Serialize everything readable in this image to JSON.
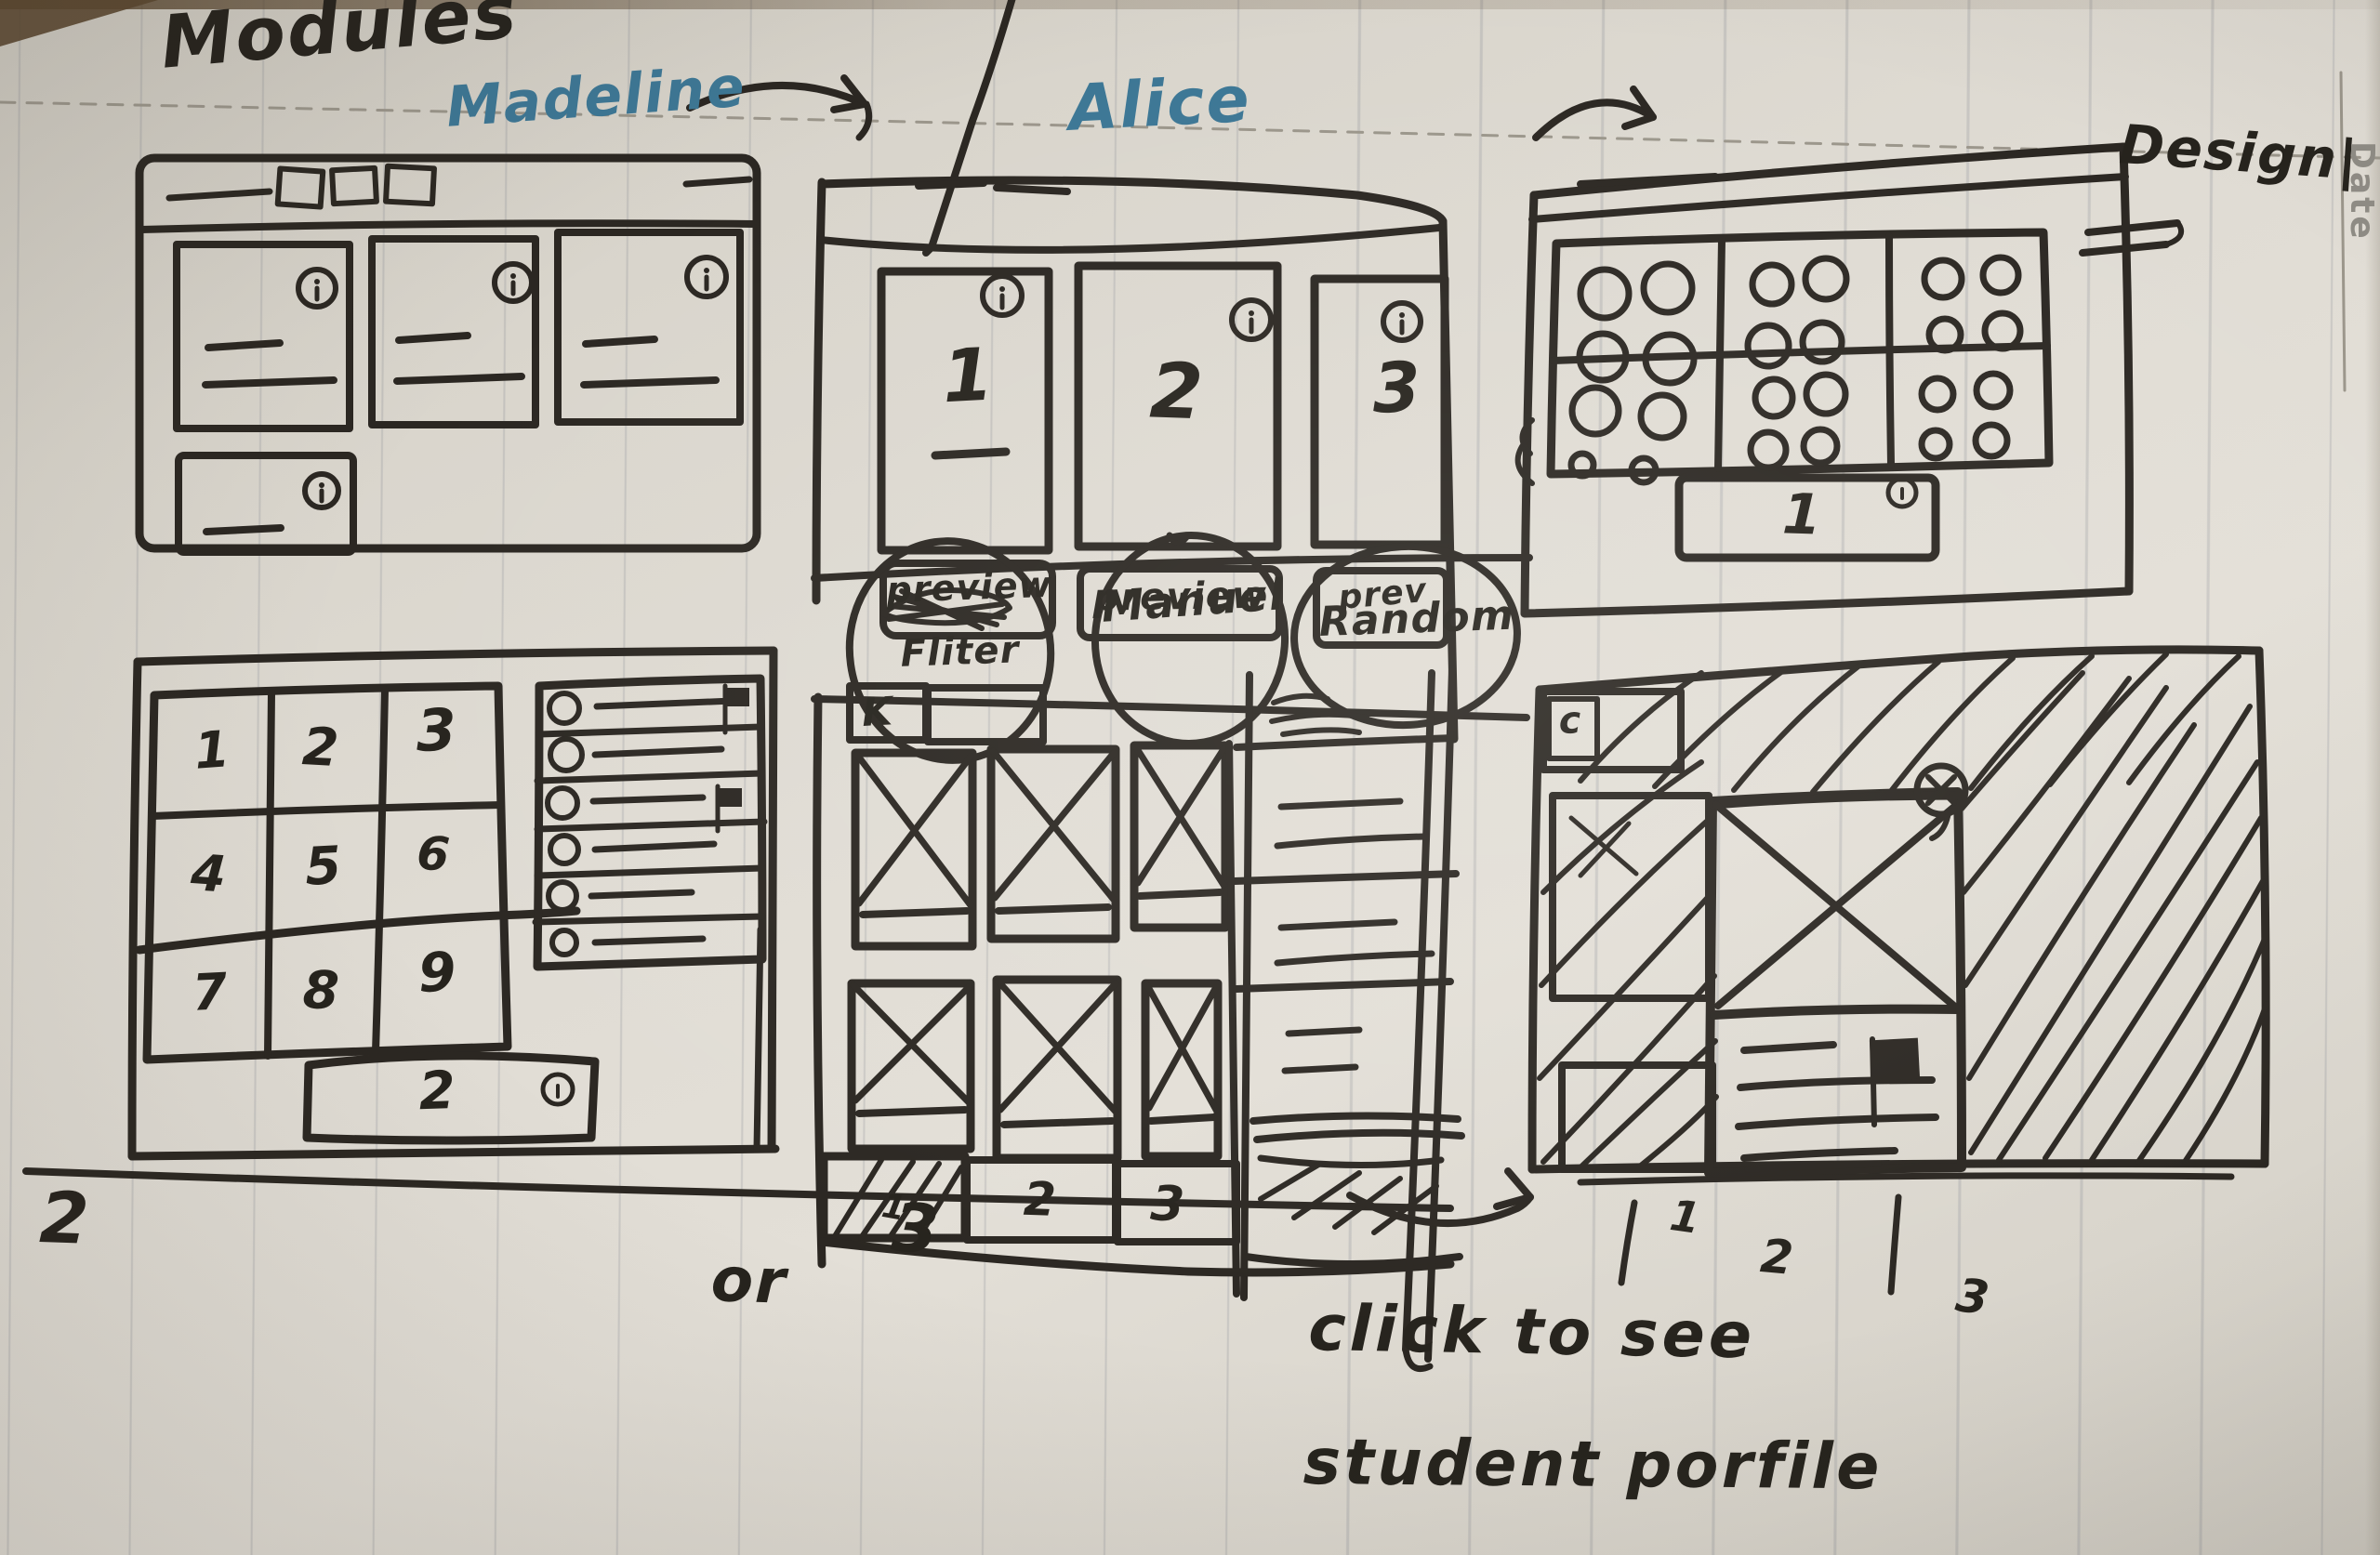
{
  "annotations": {
    "title": "Modules",
    "persona_left": "Madeline",
    "persona_middle": "Alice",
    "design_label": "Design|",
    "margin_date_label": "Date",
    "variant_left": "2",
    "variant_or": "or",
    "variant_right": "3",
    "note_line1": "click to see",
    "note_line2": "student porfile"
  },
  "modules_window": {
    "cards": [
      {
        "number": "1",
        "button_label": "preview"
      },
      {
        "number": "2",
        "button_label": "preview"
      },
      {
        "number": "3",
        "button_label": "prev"
      }
    ]
  },
  "sort_bubbles": {
    "option1": "Fliter",
    "option2": "Manuel",
    "option3": "Random"
  },
  "groups_window": {
    "pagination_label": "1"
  },
  "numbers_window": {
    "grid": [
      "1",
      "2",
      "3",
      "4",
      "5",
      "6",
      "7",
      "8",
      "9"
    ],
    "pagination_label": "2"
  },
  "gallery_window": {
    "back_label": "K",
    "pagination": [
      "1",
      "2",
      "3"
    ]
  },
  "profile_window": {
    "back_label": "c",
    "pagination": [
      "1",
      "2",
      "3"
    ]
  }
}
